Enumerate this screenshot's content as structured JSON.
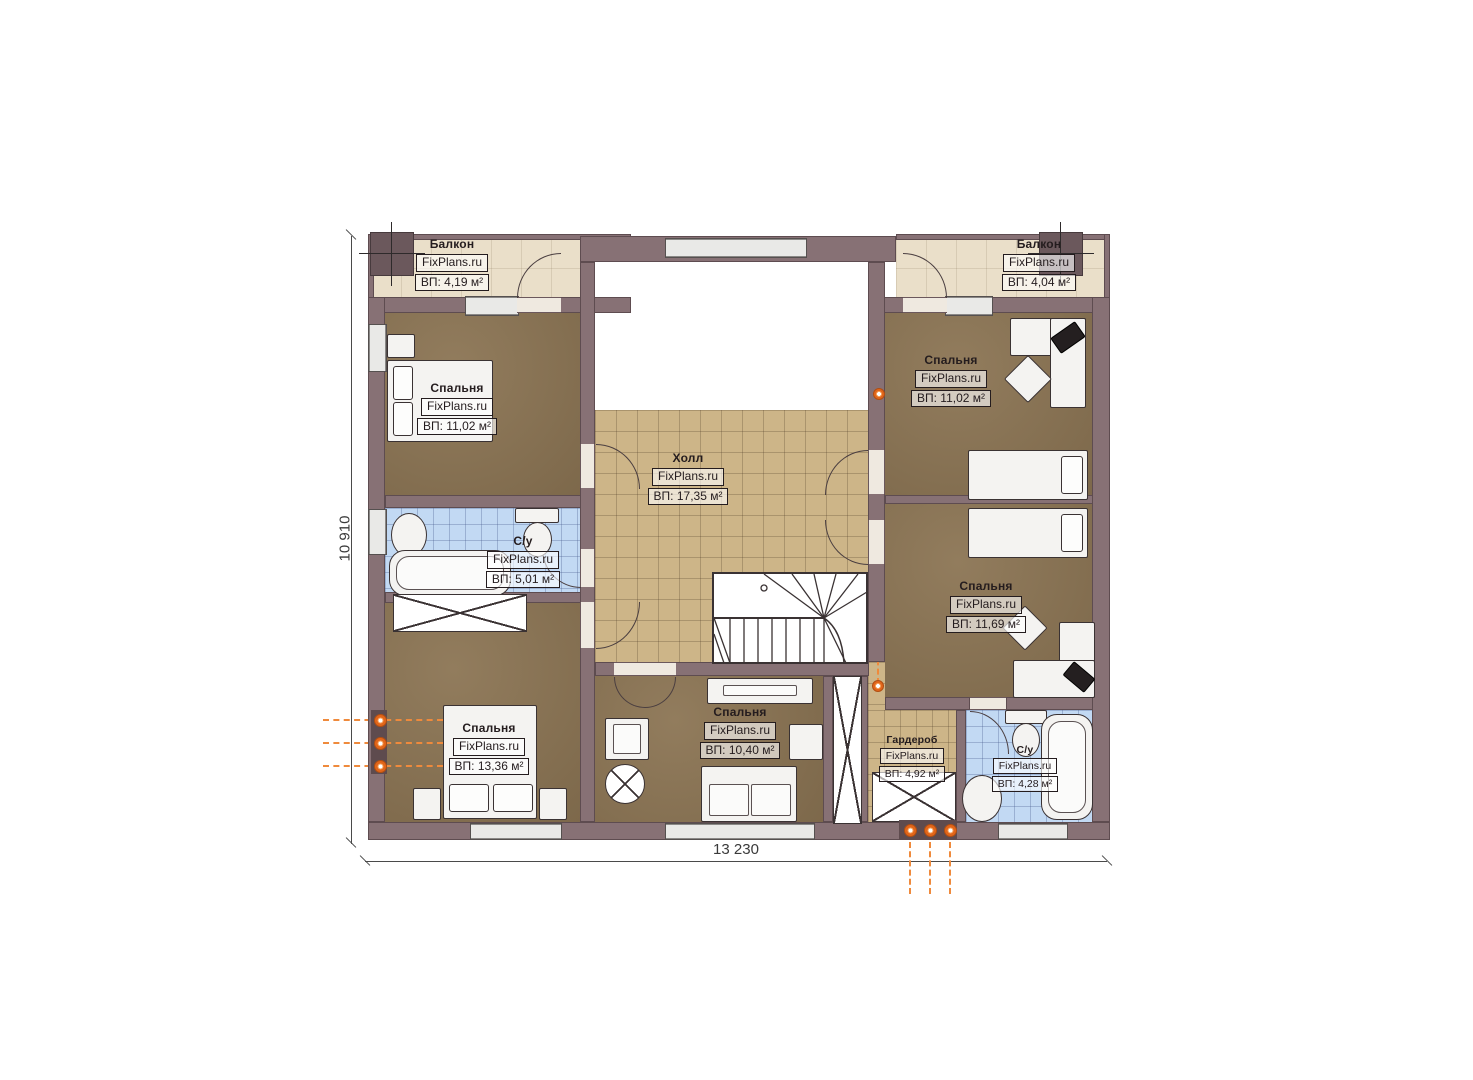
{
  "rooms": {
    "balcony_left": {
      "name": "Балкон",
      "brand": "FixPlans.ru",
      "area": "ВП: 4,19 м²"
    },
    "balcony_right": {
      "name": "Балкон",
      "brand": "FixPlans.ru",
      "area": "ВП: 4,04 м²"
    },
    "bedroom_tl": {
      "name": "Спальня",
      "brand": "FixPlans.ru",
      "area": "ВП: 11,02 м²"
    },
    "bedroom_tr": {
      "name": "Спальня",
      "brand": "FixPlans.ru",
      "area": "ВП: 11,02 м²"
    },
    "hall": {
      "name": "Холл",
      "brand": "FixPlans.ru",
      "area": "ВП: 17,35 м²"
    },
    "bathroom_left": {
      "name": "С/у",
      "brand": "FixPlans.ru",
      "area": "ВП: 5,01 м²"
    },
    "bedroom_mr": {
      "name": "Спальня",
      "brand": "FixPlans.ru",
      "area": "ВП: 11,69 м²"
    },
    "bedroom_bl": {
      "name": "Спальня",
      "brand": "FixPlans.ru",
      "area": "ВП: 13,36 м²"
    },
    "bedroom_bm": {
      "name": "Спальня",
      "brand": "FixPlans.ru",
      "area": "ВП: 10,40 м²"
    },
    "wardrobe": {
      "name": "Гардероб",
      "brand": "FixPlans.ru",
      "area": "ВП: 4,92 м²"
    },
    "bathroom_right": {
      "name": "С/у",
      "brand": "FixPlans.ru",
      "area": "ВП: 4,28 м²"
    }
  },
  "dimensions": {
    "width": "13 230",
    "height": "10 910"
  },
  "colors": {
    "wall": "#877175",
    "floor_wood": "#8b7453",
    "tile_tan": "#cdb588",
    "tile_blue": "#c2d9f3",
    "balcony": "#eadfc9",
    "accent_orange": "#e87820"
  }
}
